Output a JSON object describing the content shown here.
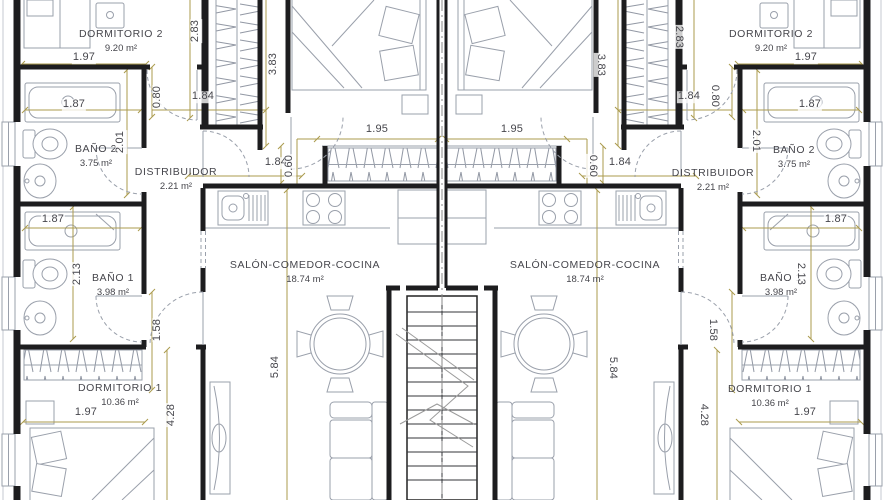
{
  "plan": {
    "drawing_type": "floor plan",
    "language": "es"
  },
  "rooms": {
    "dormitorio2": {
      "name": "DORMITORIO 2",
      "area": "9.20 m²"
    },
    "bano2": {
      "name": "BAÑO 2",
      "area": "3.75 m²"
    },
    "distribuidor": {
      "name": "DISTRIBUIDOR",
      "area": "2.21 m²"
    },
    "bano1": {
      "name": "BAÑO 1",
      "area": "3.98 m²"
    },
    "dormitorio1": {
      "name": "DORMITORIO 1",
      "area": "10.36 m²"
    },
    "salon": {
      "name": "SALÓN-COMEDOR-COCINA",
      "area": "18.74 m²"
    }
  },
  "room_labels": [
    {
      "room": "dormitorio2",
      "x": 121,
      "y": 35
    },
    {
      "room": "bano2",
      "x": 96,
      "y": 150
    },
    {
      "room": "distribuidor",
      "x": 176,
      "y": 173
    },
    {
      "room": "bano1",
      "x": 113,
      "y": 279
    },
    {
      "room": "dormitorio1",
      "x": 120,
      "y": 389
    },
    {
      "room": "salon",
      "x": 305,
      "y": 266
    },
    {
      "room": "dormitorio2",
      "x": 771,
      "y": 35
    },
    {
      "room": "bano2",
      "x": 794,
      "y": 151
    },
    {
      "room": "distribuidor",
      "x": 713,
      "y": 174
    },
    {
      "room": "bano1",
      "x": 781,
      "y": 279
    },
    {
      "room": "dormitorio1",
      "x": 770,
      "y": 390
    },
    {
      "room": "salon",
      "x": 585,
      "y": 266
    }
  ],
  "dimensions": [
    {
      "v": "1.97",
      "x": 84,
      "y": 58,
      "rot": "h"
    },
    {
      "v": "2.83",
      "x": 196,
      "y": 31,
      "rot": "l"
    },
    {
      "v": "3.83",
      "x": 274,
      "y": 64,
      "rot": "l"
    },
    {
      "v": "0.80",
      "x": 158,
      "y": 97,
      "rot": "l"
    },
    {
      "v": "1.84",
      "x": 203,
      "y": 97,
      "rot": "h"
    },
    {
      "v": "1.87",
      "x": 74,
      "y": 105,
      "rot": "h"
    },
    {
      "v": "2.01",
      "x": 121,
      "y": 142,
      "rot": "l"
    },
    {
      "v": "1.84",
      "x": 276,
      "y": 163,
      "rot": "h"
    },
    {
      "v": "0.60",
      "x": 290,
      "y": 166,
      "rot": "l"
    },
    {
      "v": "1.95",
      "x": 377,
      "y": 130,
      "rot": "h"
    },
    {
      "v": "1.87",
      "x": 53,
      "y": 220,
      "rot": "h"
    },
    {
      "v": "2.13",
      "x": 78,
      "y": 274,
      "rot": "l"
    },
    {
      "v": "1.58",
      "x": 158,
      "y": 330,
      "rot": "l"
    },
    {
      "v": "5.84",
      "x": 276,
      "y": 367,
      "rot": "l"
    },
    {
      "v": "1.97",
      "x": 86,
      "y": 413,
      "rot": "h"
    },
    {
      "v": "4.28",
      "x": 172,
      "y": 415,
      "rot": "l"
    },
    {
      "v": "1.97",
      "x": 806,
      "y": 58,
      "rot": "h"
    },
    {
      "v": "2.83",
      "x": 678,
      "y": 37,
      "rot": "r"
    },
    {
      "v": "3.83",
      "x": 600,
      "y": 65,
      "rot": "r"
    },
    {
      "v": "0.80",
      "x": 714,
      "y": 96,
      "rot": "r"
    },
    {
      "v": "1.84",
      "x": 689,
      "y": 97,
      "rot": "h"
    },
    {
      "v": "1.87",
      "x": 810,
      "y": 105,
      "rot": "h"
    },
    {
      "v": "2.01",
      "x": 755,
      "y": 141,
      "rot": "r"
    },
    {
      "v": "1.84",
      "x": 620,
      "y": 163,
      "rot": "h"
    },
    {
      "v": "0.60",
      "x": 592,
      "y": 166,
      "rot": "r"
    },
    {
      "v": "1.95",
      "x": 512,
      "y": 130,
      "rot": "h"
    },
    {
      "v": "1.87",
      "x": 836,
      "y": 220,
      "rot": "h"
    },
    {
      "v": "2.13",
      "x": 800,
      "y": 274,
      "rot": "r"
    },
    {
      "v": "1.58",
      "x": 712,
      "y": 330,
      "rot": "r"
    },
    {
      "v": "5.84",
      "x": 612,
      "y": 368,
      "rot": "r"
    },
    {
      "v": "1.97",
      "x": 805,
      "y": 413,
      "rot": "h"
    },
    {
      "v": "4.28",
      "x": 703,
      "y": 415,
      "rot": "r"
    }
  ],
  "colors": {
    "wall": "#1d1d1f",
    "dim": "#ab9b4e",
    "furn": "#9aa0ab",
    "text": "#46464c",
    "hatch": "#9298a4"
  }
}
